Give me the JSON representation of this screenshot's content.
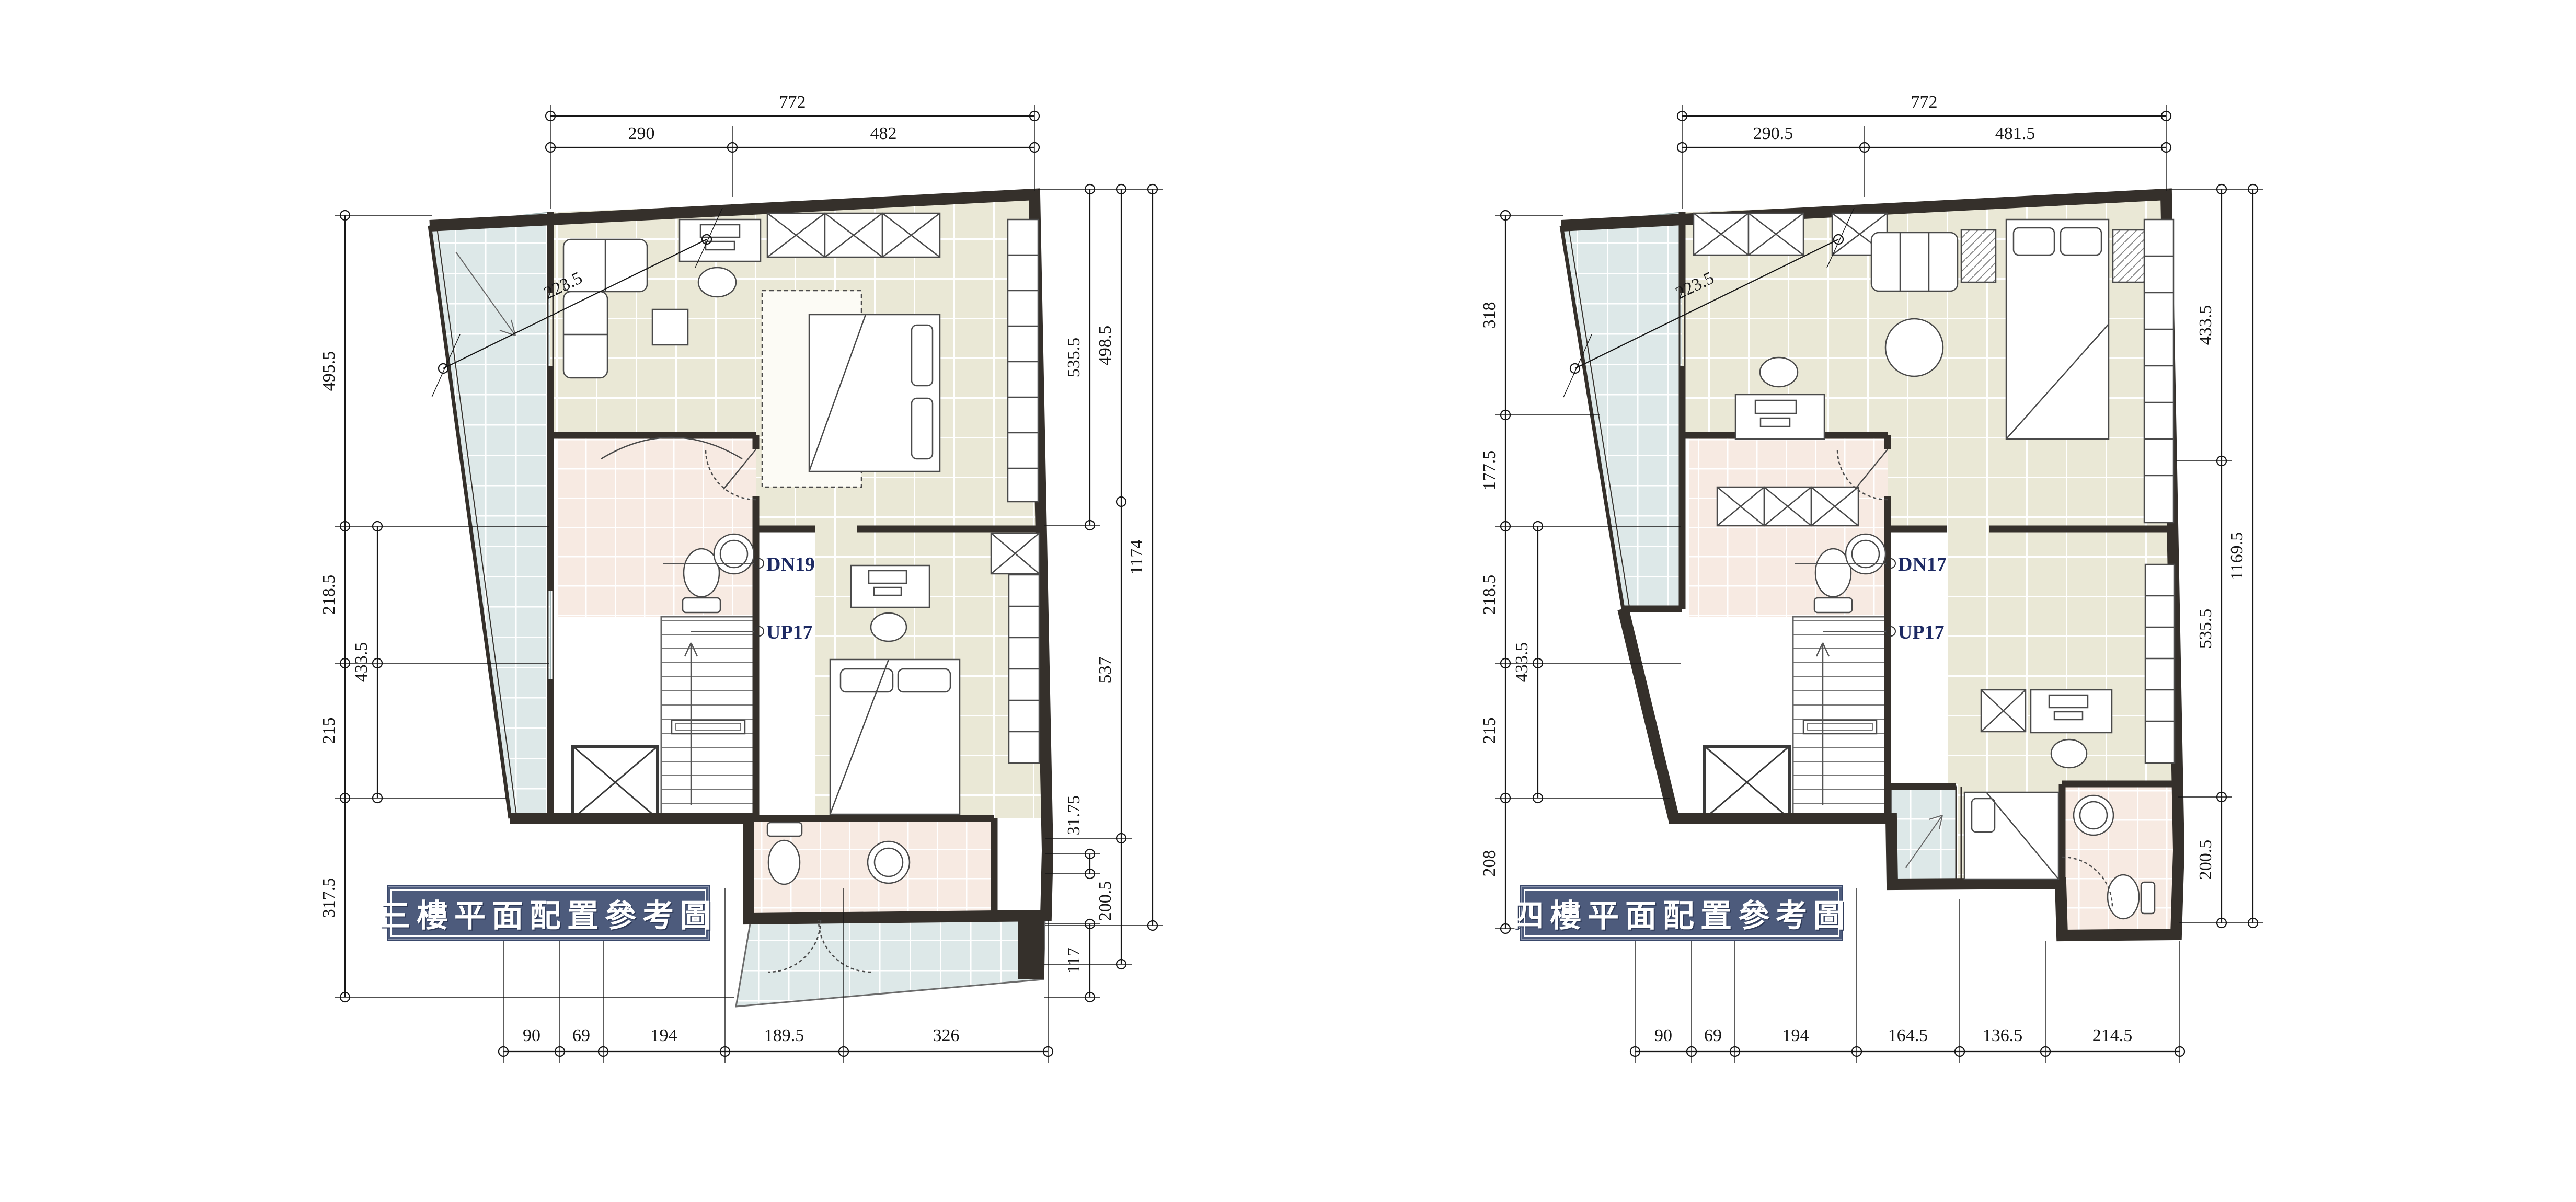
{
  "document": {
    "type": "architectural-floor-plan-drawing",
    "background": "#ffffff"
  },
  "colors": {
    "wall": "#35302b",
    "floor_tile": "#eae8d6",
    "bath_tile": "#f7eae2",
    "balcony_tile": "#dde8e8",
    "grout": "#ffffff",
    "title_bg": "#4d5b7c",
    "title_text": "#ffffff",
    "stair_label": "#1d2a63",
    "dim_text": "#161616",
    "furniture_line": "#4a4a4a"
  },
  "plans": [
    {
      "id": "floor3",
      "title": "三樓平面配置參考圖",
      "stair_down": "DN19",
      "stair_up": "UP17",
      "dims": {
        "diag": "223.5",
        "top": [
          "772"
        ],
        "top2": [
          "290",
          "482"
        ],
        "left_outer": [
          "495.5",
          "218.5",
          "215",
          "317.5"
        ],
        "left_inner": [
          "433.5"
        ],
        "right_inner": [
          "535.5",
          "31.75",
          "117"
        ],
        "right_mid": [
          "498.5",
          "537",
          "200.5"
        ],
        "right_outer": [
          "1174"
        ],
        "bottom": [
          "90",
          "69",
          "194",
          "189.5",
          "326"
        ]
      }
    },
    {
      "id": "floor4",
      "title": "四樓平面配置參考圖",
      "stair_down": "DN17",
      "stair_up": "UP17",
      "dims": {
        "diag": "223.5",
        "top": [
          "772"
        ],
        "top2": [
          "290.5",
          "481.5"
        ],
        "left_outer": [
          "318",
          "177.5",
          "218.5",
          "215",
          "208"
        ],
        "left_inner": [
          "433.5"
        ],
        "right_inner": [
          "433.5",
          "535.5",
          "200.5"
        ],
        "right_outer": [
          "1169.5"
        ],
        "bottom": [
          "90",
          "69",
          "194",
          "164.5",
          "136.5",
          "214.5"
        ]
      }
    }
  ]
}
